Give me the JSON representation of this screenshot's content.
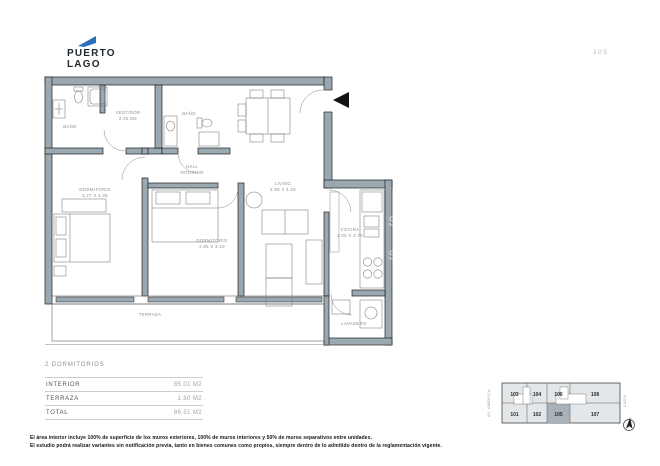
{
  "brand": {
    "line1": "PUERTO",
    "line2": "LAGO",
    "flag_color": "#2e6fb7"
  },
  "meta": {
    "unit_number": "105"
  },
  "plan": {
    "rooms": [
      {
        "id": "banio-1",
        "label": "BAÑO"
      },
      {
        "id": "vestidor",
        "label": "VESTIDOR",
        "detail": "2.45 M2"
      },
      {
        "id": "banio-2",
        "label": "BAÑO"
      },
      {
        "id": "hall",
        "label": "HALL",
        "detail": "INTERIOR"
      },
      {
        "id": "dormitorio-1",
        "label": "DORMITORIO",
        "detail": "3.27 X 4.45"
      },
      {
        "id": "dormitorio-2",
        "label": "DORMITORIO",
        "detail": "2.85 X 3.10"
      },
      {
        "id": "living",
        "label": "LIVING",
        "detail": "2.90 X 4.25"
      },
      {
        "id": "cocina",
        "label": "COCINA",
        "detail": "2.00 X 3.70"
      },
      {
        "id": "lavadero",
        "label": "LAVADERO"
      },
      {
        "id": "terraza",
        "label": "TERRAZA"
      }
    ],
    "watermark_letter": "S"
  },
  "summary": {
    "title": "2 DORMITORIOS",
    "rows": [
      {
        "label": "INTERIOR",
        "value": "85.01 M2"
      },
      {
        "label": "TERRAZA",
        "value": "1.50 M2"
      },
      {
        "label": "TOTAL",
        "value": "86.51 M2"
      }
    ]
  },
  "keyplan": {
    "cells": [
      {
        "num": "103"
      },
      {
        "num": "104"
      },
      {
        "num": "106"
      },
      {
        "num": "108"
      },
      {
        "num": "101"
      },
      {
        "num": "102"
      },
      {
        "num": "105"
      },
      {
        "num": "107"
      }
    ],
    "highlighted_unit": "105",
    "street_left": "AV. AMÉRICA",
    "street_right": "LAGO"
  },
  "disclaimer": {
    "line1": "El área interior incluye 100% de superficie de los muros exteriores, 100% de muros interiores y 50% de muros separativos entre unidades.",
    "line2": "El estudio podrá realizar variantes sin notificación previa, tanto en bienes comunes como propios, siempre dentro de lo admitido dentro de la reglamentación vigente."
  }
}
